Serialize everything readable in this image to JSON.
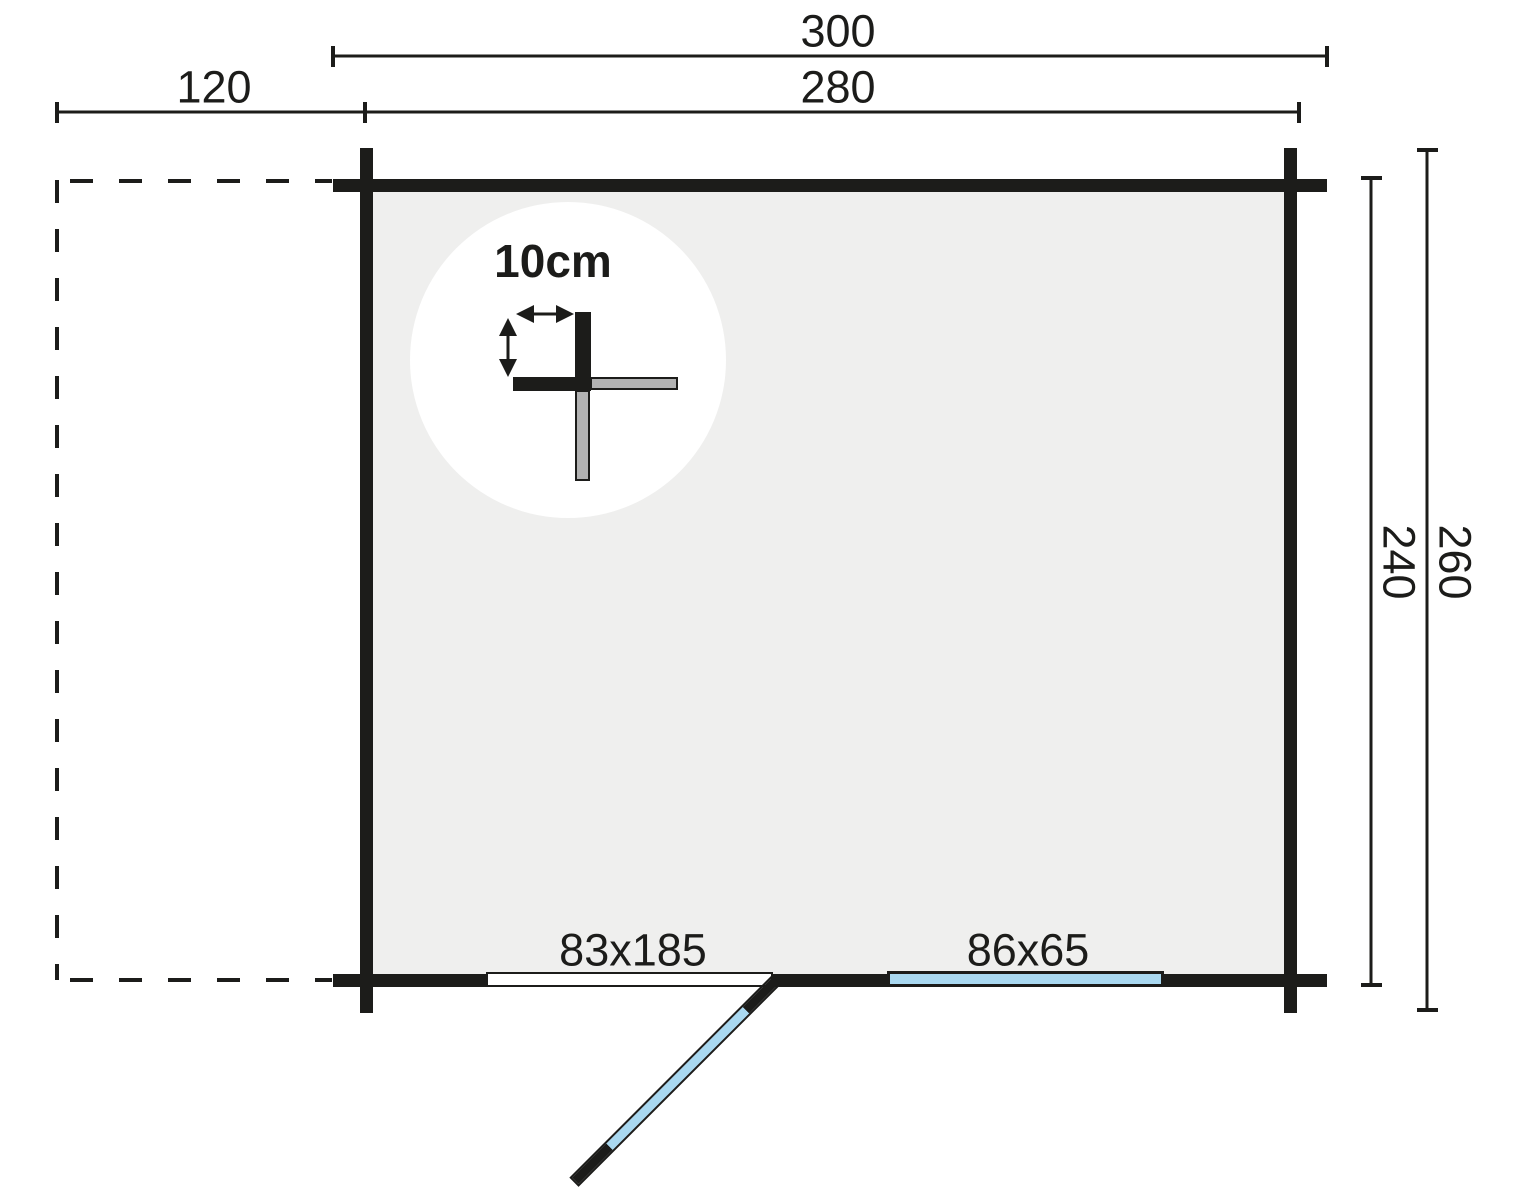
{
  "colors": {
    "background": "#ffffff",
    "ink": "#1c1c1a",
    "floor_fill": "#efefee",
    "glazing_blue": "#a9d8f0",
    "log_section_gray": "#b2b2b2"
  },
  "dimensions": {
    "overall_width": "300",
    "outer_width": "280",
    "canopy_width": "120",
    "inner_depth": "240",
    "overall_depth": "260"
  },
  "openings": {
    "door": "83x185",
    "window": "86x65"
  },
  "detail": {
    "wall_thickness": "10cm"
  }
}
